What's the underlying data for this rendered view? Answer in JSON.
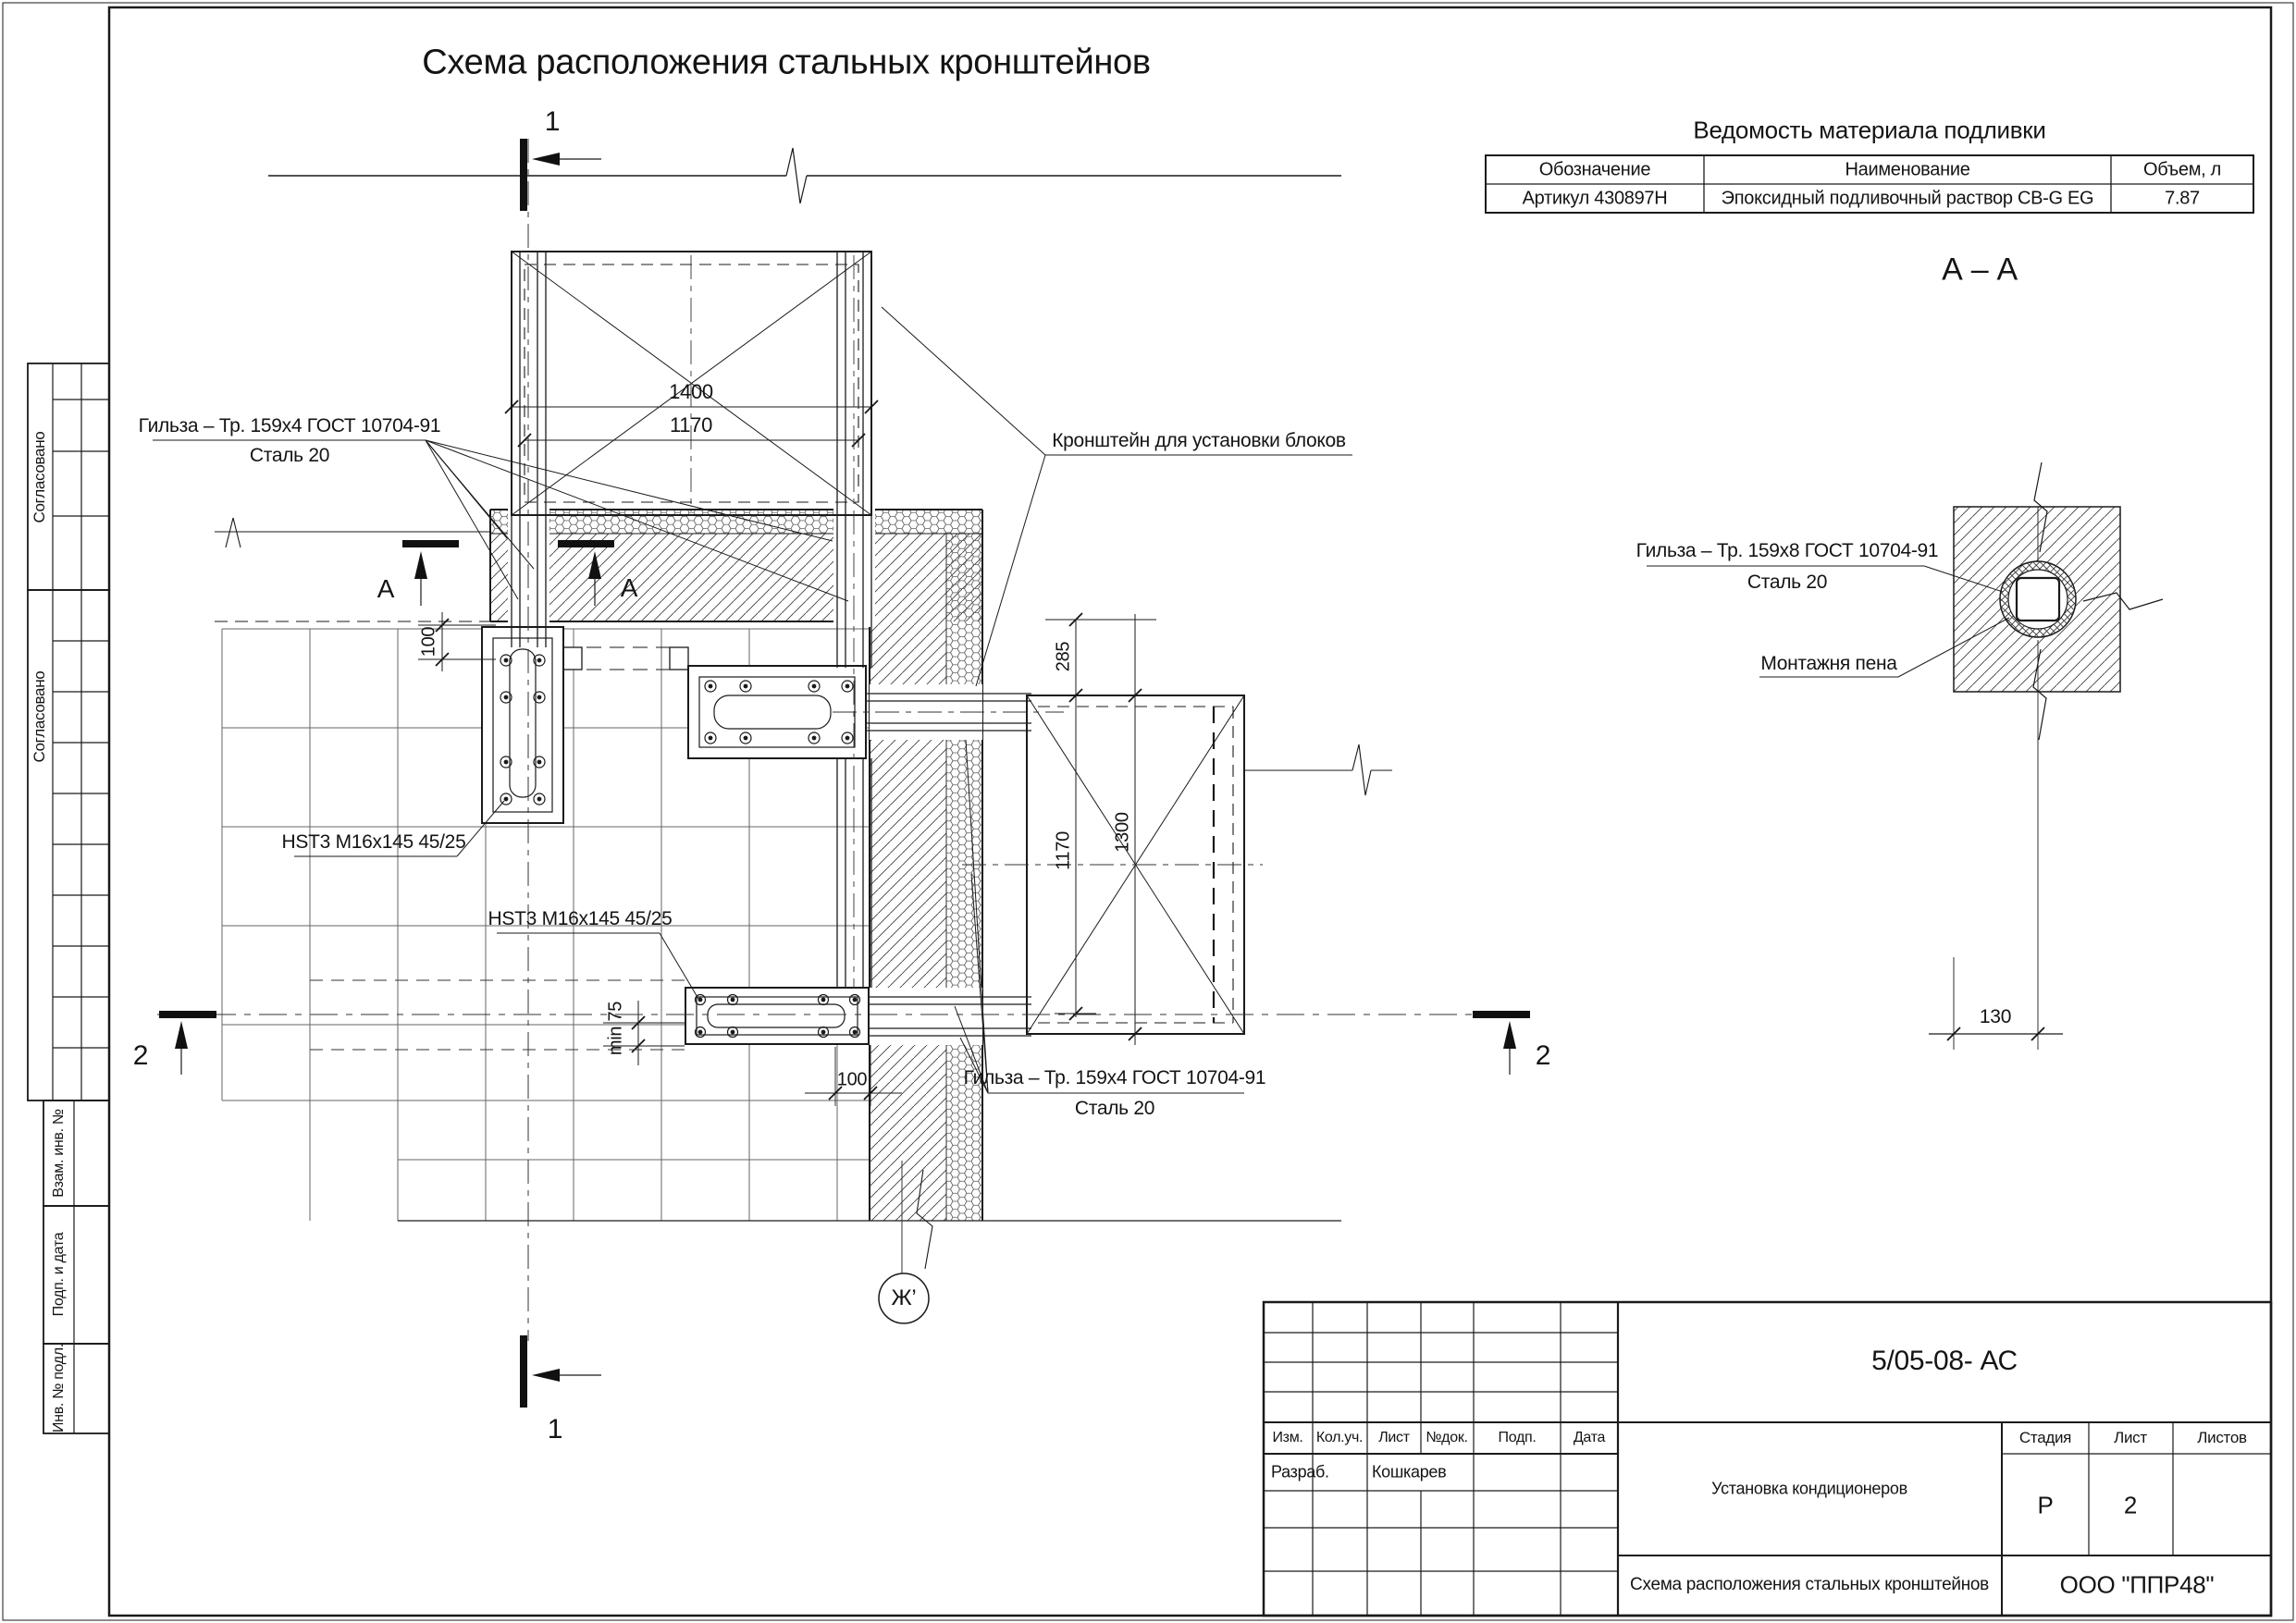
{
  "page": {
    "title": "Схема расположения стальных кронштейнов"
  },
  "materials_table": {
    "title": "Ведомость материала подливки",
    "columns": [
      "Обозначение",
      "Наименование",
      "Объем, л"
    ],
    "rows": [
      [
        "Артикул 430897Н",
        "Эпоксидный подливочный раствор CB-G EG",
        "7.87"
      ]
    ]
  },
  "section_aa": {
    "title": "А – А",
    "sleeve_label_line1": "Гильза – Тр. 159х8 ГОСТ 10704-91",
    "sleeve_label_line2": "Сталь 20",
    "foam_label": "Монтажня пена",
    "dim_width": "130"
  },
  "plan": {
    "sleeve_top_line1": "Гильза – Тр. 159х4 ГОСТ 10704-91",
    "sleeve_top_line2": "Сталь 20",
    "bracket_label": "Кронштейн для установки блоков",
    "anchor_label_1": "HST3 M16x145 45/25",
    "anchor_label_2": "HST3 M16x145 45/25",
    "sleeve_bottom_line1": "Гильза – Тр. 159х4 ГОСТ 10704-91",
    "sleeve_bottom_line2": "Сталь 20",
    "dims": {
      "block_width": "1400",
      "block_width_inner": "1170",
      "offset_top": "100",
      "gap": "285",
      "block2_height": "1300",
      "block2_inner": "1170",
      "min_edge": "min 75",
      "offset_bottom": "100"
    },
    "markers": {
      "section1": "1",
      "section2": "2",
      "section_a": "А",
      "axis": "Ж’"
    }
  },
  "sidebar": {
    "approved1": "Согласовано",
    "approved2": "Согласовано",
    "vzam": "Взам. инв. №",
    "podp": "Подп. и дата",
    "inv": "Инв. № подл."
  },
  "title_block": {
    "doc_number": "5/05-08- АС",
    "headers": [
      "Изм.",
      "Кол.уч.",
      "Лист",
      "№док.",
      "Подп.",
      "Дата"
    ],
    "developer_label": "Разраб.",
    "developer_name": "Кошкарев",
    "project": "Установка кондиционеров",
    "stage_label": "Стадия",
    "sheet_label": "Лист",
    "sheets_label": "Листов",
    "stage": "Р",
    "sheet": "2",
    "drawing_title": "Схема расположения стальных кронштейнов",
    "company": "ООО \"ППР48\""
  }
}
